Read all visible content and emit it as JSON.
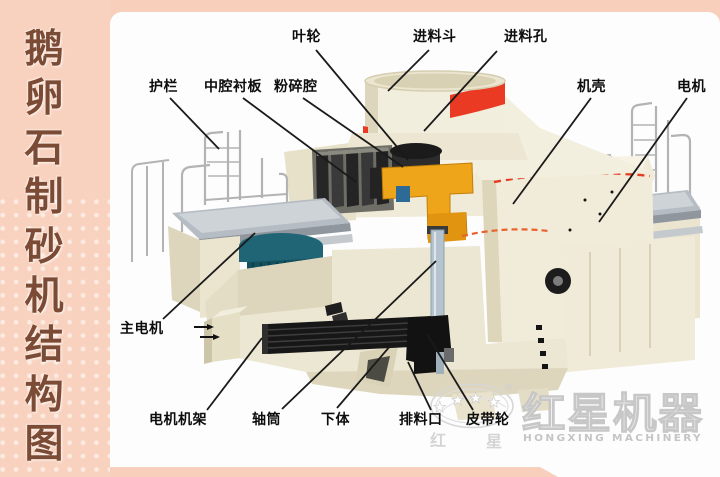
{
  "sidebar": {
    "title": "鹅卵石制砂机结构图",
    "text_color": "#7b4b36",
    "bg": "#f8d2bf"
  },
  "panel": {
    "bg": "#fdfdfe"
  },
  "diagram": {
    "line_color": "#1a1a1a",
    "label_color": "#0d0d0d",
    "labels": [
      {
        "id": "impeller",
        "text": "叶轮",
        "tx": 292,
        "ty": 29,
        "x1": 316,
        "y1": 50,
        "x2": 408,
        "y2": 160
      },
      {
        "id": "feed-hopper",
        "text": "进料斗",
        "tx": 413,
        "ty": 29,
        "x1": 429,
        "y1": 50,
        "x2": 388,
        "y2": 91
      },
      {
        "id": "feed-hole",
        "text": "进料孔",
        "tx": 504,
        "ty": 29,
        "x1": 497,
        "y1": 51,
        "x2": 424,
        "y2": 131
      },
      {
        "id": "guardrail",
        "text": "护栏",
        "tx": 149,
        "ty": 79,
        "x1": 170,
        "y1": 98,
        "x2": 219,
        "y2": 149
      },
      {
        "id": "middle-cavity-liner",
        "text": "中腔衬板",
        "tx": 204,
        "ty": 79,
        "x1": 243,
        "y1": 98,
        "x2": 356,
        "y2": 182
      },
      {
        "id": "crushing-cavity",
        "text": "粉碎腔",
        "tx": 274,
        "ty": 79,
        "x1": 303,
        "y1": 98,
        "x2": 403,
        "y2": 167
      },
      {
        "id": "casing",
        "text": "机壳",
        "tx": 577,
        "ty": 79,
        "x1": 591,
        "y1": 98,
        "x2": 513,
        "y2": 204
      },
      {
        "id": "motor",
        "text": "电机",
        "tx": 677,
        "ty": 79,
        "x1": 687,
        "y1": 98,
        "x2": 599,
        "y2": 222
      },
      {
        "id": "main-motor",
        "text": "主电机",
        "tx": 120,
        "ty": 321,
        "x1": 163,
        "y1": 319,
        "x2": 255,
        "y2": 233
      },
      {
        "id": "motor-frame",
        "text": "电机机架",
        "tx": 149,
        "ty": 412,
        "x1": 207,
        "y1": 410,
        "x2": 262,
        "y2": 338
      },
      {
        "id": "shaft-cylinder",
        "text": "轴筒",
        "tx": 252,
        "ty": 412,
        "x1": 282,
        "y1": 409,
        "x2": 436,
        "y2": 261
      },
      {
        "id": "lower-body",
        "text": "下体",
        "tx": 321,
        "ty": 412,
        "x1": 337,
        "y1": 408,
        "x2": 391,
        "y2": 345
      },
      {
        "id": "discharge-port",
        "text": "排料口",
        "tx": 399,
        "ty": 412,
        "x1": 431,
        "y1": 410,
        "x2": 408,
        "y2": 362
      },
      {
        "id": "belt-pulley",
        "text": "皮带轮",
        "tx": 466,
        "ty": 412,
        "x1": 473,
        "y1": 410,
        "x2": 427,
        "y2": 334
      }
    ]
  },
  "logo": {
    "cn": "红星机器",
    "en": "HONGXING MACHINERY",
    "reg": "®",
    "star": "★",
    "oval_left": "红",
    "oval_right": "星"
  },
  "machine_colors": {
    "cream": "#ece7d3",
    "accent_red": "#ea3a23",
    "part_yellow": "#efa51a",
    "motor_teal": "#1e6374",
    "deck_gray": "#b6bcc3",
    "shaft_blue": "#b4c3cd"
  }
}
